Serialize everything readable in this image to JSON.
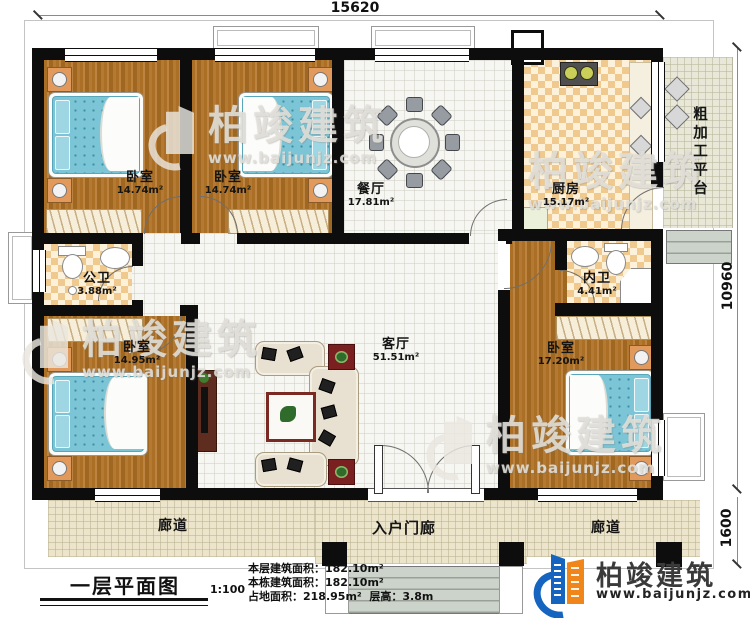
{
  "dimensions": {
    "top_width": "15620",
    "right_height": "10960",
    "porch_depth": "1600"
  },
  "rooms": {
    "bedroom_top_left": {
      "name": "卧室",
      "area": "14.74m²"
    },
    "bedroom_top_mid": {
      "name": "卧室",
      "area": "14.74m²"
    },
    "dining": {
      "name": "餐厅",
      "area": "17.81m²"
    },
    "kitchen": {
      "name": "厨房",
      "area": "15.17m²"
    },
    "platform": {
      "name": "粗加工平台"
    },
    "public_bath": {
      "name": "公卫",
      "area": "3.88m²"
    },
    "inner_bath": {
      "name": "内卫",
      "area": "4.41m²"
    },
    "bedroom_bottom_left": {
      "name": "卧室",
      "area": "14.95m²"
    },
    "bedroom_bottom_right": {
      "name": "卧室",
      "area": "17.20m²"
    },
    "living": {
      "name": "客厅",
      "area": "51.51m²"
    },
    "entry_porch": {
      "name": "入户门廊"
    },
    "corridor_left": {
      "name": "廊道"
    },
    "corridor_right": {
      "name": "廊道"
    }
  },
  "title_block": {
    "plan_name": "一层平面图",
    "scale": "1:100",
    "stats": {
      "floor_area": "本层建筑面积：182.10m²",
      "building_area": "本栋建筑面积：182.10m²",
      "land_area": "占地面积：218.95m²",
      "story_height": "层高：3.8m"
    }
  },
  "logo": {
    "name": "柏竣建筑",
    "url": "www.baijunjz.com"
  },
  "watermark": {
    "text": "柏竣建筑",
    "url": "www.baijunjz.com"
  },
  "colors": {
    "wall": "#0d0d0d",
    "wood_floor": "#a9712c",
    "bed_blue": "#7cc5d6",
    "tile_checker": "#f0c98e",
    "logo_blue": "#1565c0",
    "logo_orange": "#f08519"
  }
}
